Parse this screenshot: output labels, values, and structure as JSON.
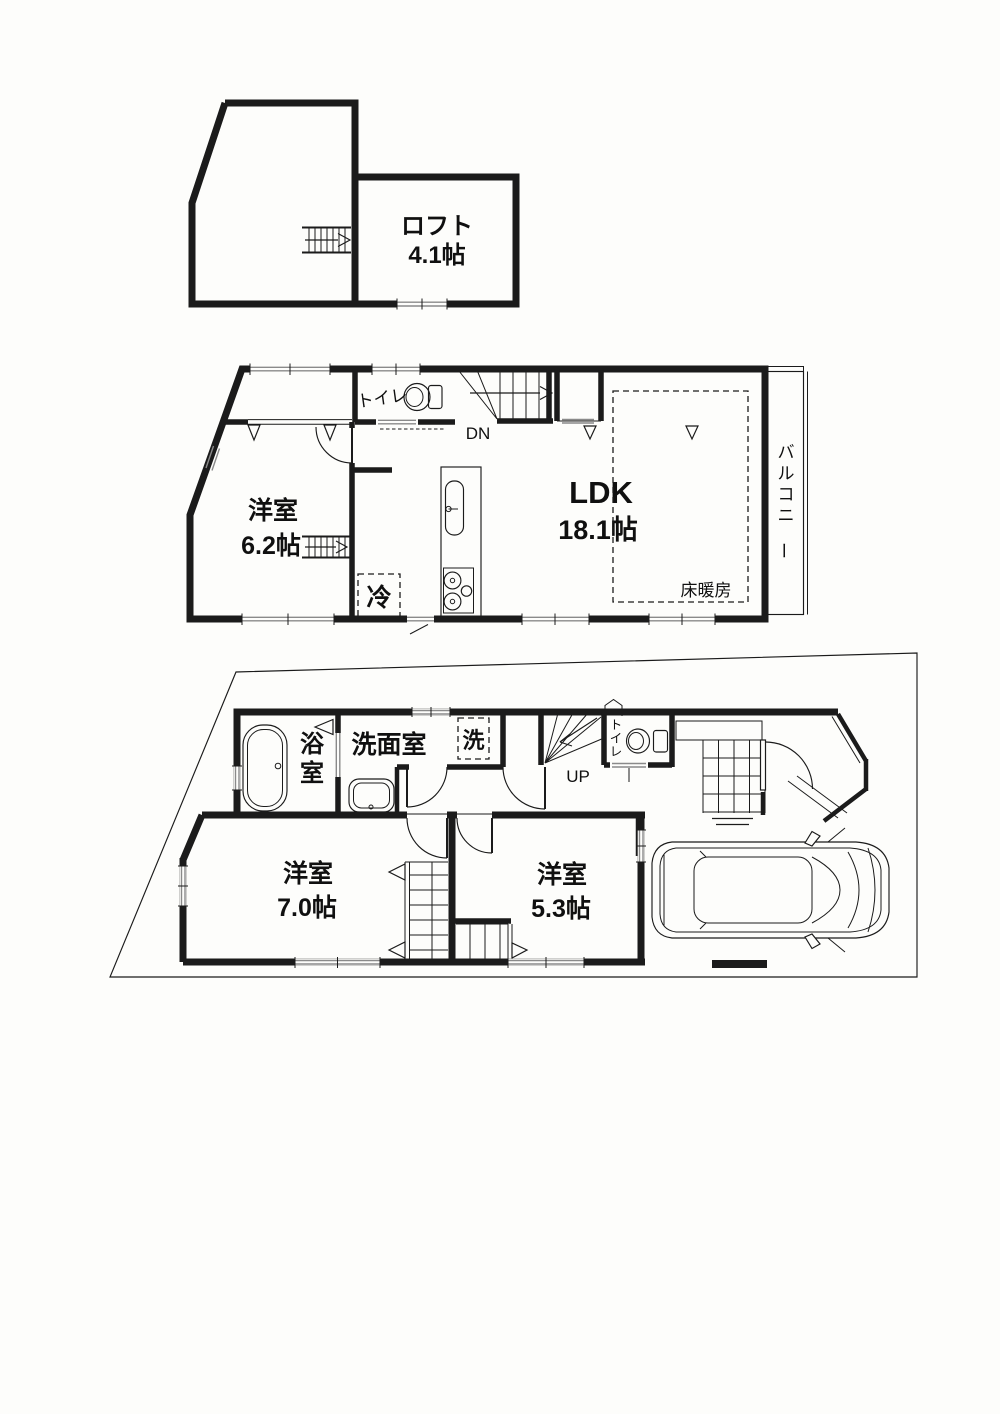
{
  "page": {
    "background": "#fdfdfb",
    "ink": "#1b1b1b",
    "window_gray": "#8a8a8a"
  },
  "floors": {
    "loft": {
      "room": {
        "name": "ロフト",
        "size": "4.1帖"
      }
    },
    "second": {
      "bedroom": {
        "name": "洋室",
        "size": "6.2帖"
      },
      "toilet_label": "トイレ",
      "stairs_label": "DN",
      "ldk": {
        "name": "LDK",
        "size": "18.1帖"
      },
      "floor_heating_label": "床暖房",
      "balcony_label": "バルコニー",
      "fridge_label": "冷"
    },
    "first": {
      "bath_label": "浴室",
      "washroom_label": "洗面室",
      "washer_label": "洗",
      "stairs_label": "UP",
      "toilet_label": "トイレ",
      "bedroom_a": {
        "name": "洋室",
        "size": "7.0帖"
      },
      "bedroom_b": {
        "name": "洋室",
        "size": "5.3帖"
      }
    }
  }
}
